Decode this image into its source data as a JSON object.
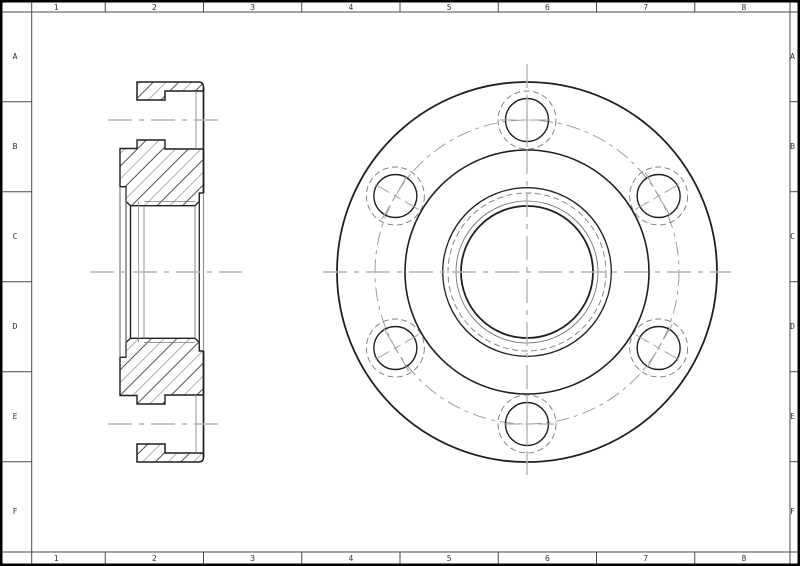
{
  "sheet": {
    "type_label": "engineering-drawing-sheet",
    "column_labels": [
      "1",
      "2",
      "3",
      "4",
      "5",
      "6",
      "7",
      "8"
    ],
    "row_labels": [
      "A",
      "B",
      "C",
      "D",
      "E",
      "F"
    ],
    "colors": {
      "paper": "#ffffff",
      "border": "#000000",
      "frame": "#4a4a4a",
      "zone_label": "#333333",
      "outline": "#1f1f1f",
      "thin_edge": "#666666",
      "hidden": "#7a7a7a",
      "centerline": "#b3b3b3",
      "bolt_centerline": "#9e9e9e",
      "hatch_dark": "#3f3f3f",
      "hatch_light": "#9c9c9c"
    }
  },
  "front_view": {
    "name": "flange-front-view",
    "center": {
      "x": 527,
      "y": 272
    },
    "circles": [
      {
        "name": "flange-od-circle",
        "r": 190,
        "weight": 1.8,
        "style": "solid"
      },
      {
        "name": "hub-od-circle",
        "r": 122,
        "weight": 1.6,
        "style": "solid"
      },
      {
        "name": "boss-rim-circle",
        "r": 84.3,
        "weight": 1.3,
        "style": "solid"
      },
      {
        "name": "recess-hidden-circle",
        "r": 79,
        "weight": 0.9,
        "style": "hidden"
      },
      {
        "name": "bore-chamfer-circle",
        "r": 71,
        "weight": 0.8,
        "style": "thin"
      },
      {
        "name": "bore-circle",
        "r": 66,
        "weight": 1.8,
        "style": "solid"
      }
    ],
    "bolt_circle_r": 152,
    "bolts": {
      "count": 6,
      "angles_deg": [
        90,
        150,
        210,
        270,
        330,
        30
      ],
      "hole_r": 21.5,
      "counterbore_r": 29,
      "tick_half_len": 27
    },
    "centerlines": {
      "vertical": {
        "x": 527,
        "y1": 64,
        "y2": 480
      },
      "horizontal": {
        "y": 272,
        "x1": 323,
        "x2": 731
      }
    }
  },
  "section_view": {
    "name": "flange-section-view",
    "centerlines": [
      {
        "name": "main-axis-centerline",
        "y": 272,
        "x1": 90,
        "x2": 242
      },
      {
        "name": "top-bolt-axis-centerline",
        "y": 120,
        "x1": 108,
        "x2": 218
      },
      {
        "name": "bottom-bolt-axis-centerline",
        "y": 424,
        "x1": 108,
        "x2": 218
      }
    ]
  }
}
